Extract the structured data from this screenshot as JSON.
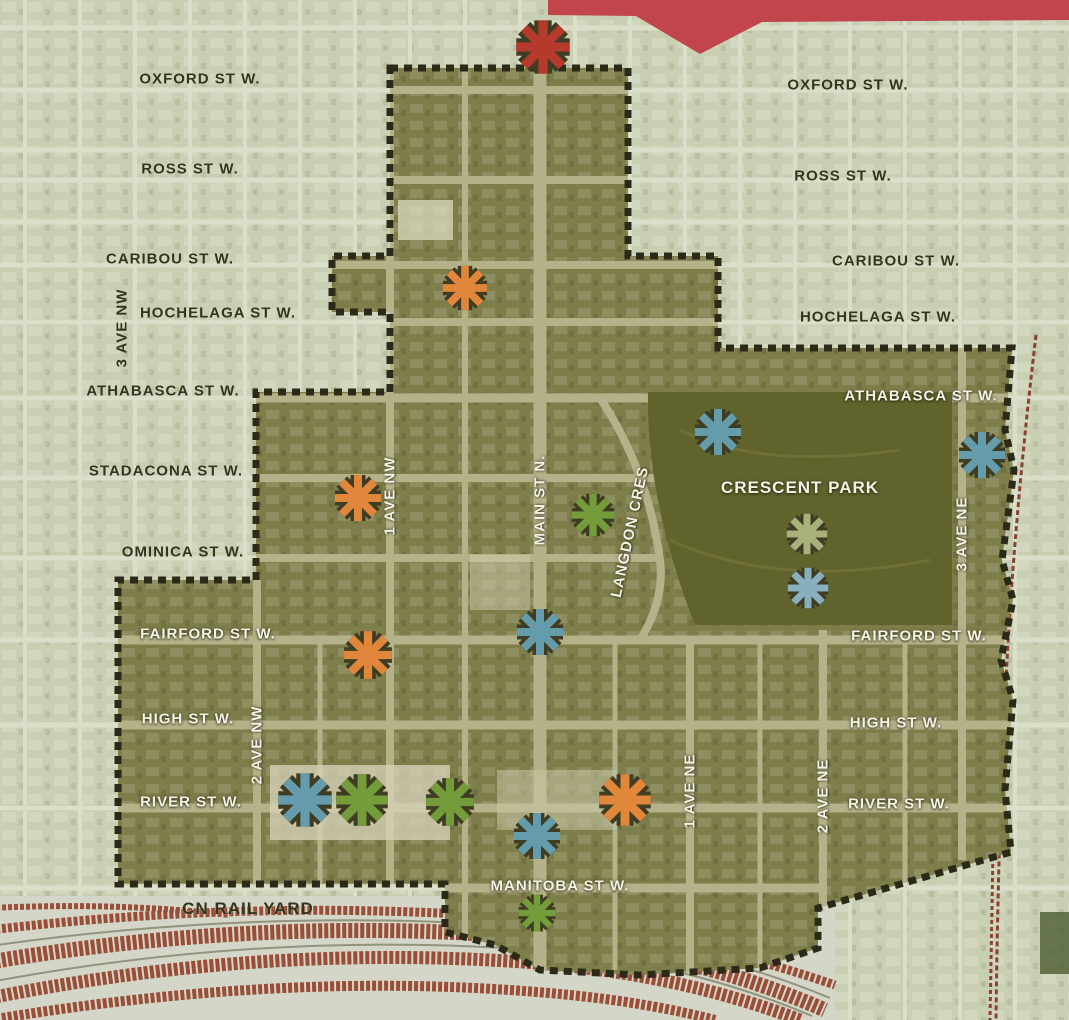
{
  "map": {
    "region": {
      "park_name": "CRESCENT PARK",
      "rail_yard_name": "CN RAIL YARD"
    },
    "palette": {
      "banner": "#c2444c",
      "outside_bg": "#c9cfb3",
      "inside_bg": "#7e7e4b",
      "park": "#61632d",
      "rail_band": "#9a4e39",
      "rail_line": "#8a4331",
      "boundary": "#2b2a19",
      "outline": "#3e3c22",
      "red": "#b53a2c",
      "orange": "#e1873c",
      "teal": "#649cab",
      "green": "#759c3b",
      "sage": "#a8b17b",
      "lightblue": "#87afbd"
    },
    "street_labels": [
      {
        "id": "oxford-st-w-left",
        "text": "OXFORD ST W.",
        "x": 200,
        "y": 79,
        "tone": "dark",
        "rot": 0
      },
      {
        "id": "oxford-st-w-right",
        "text": "OXFORD ST W.",
        "x": 848,
        "y": 85,
        "tone": "dark",
        "rot": 0
      },
      {
        "id": "ross-st-w-left",
        "text": "ROSS ST W.",
        "x": 190,
        "y": 169,
        "tone": "dark",
        "rot": 0
      },
      {
        "id": "ross-st-w-right",
        "text": "ROSS ST W.",
        "x": 843,
        "y": 176,
        "tone": "dark",
        "rot": 0
      },
      {
        "id": "caribou-st-w-left",
        "text": "CARIBOU ST W.",
        "x": 170,
        "y": 259,
        "tone": "dark",
        "rot": 0
      },
      {
        "id": "caribou-st-w-right",
        "text": "CARIBOU ST W.",
        "x": 896,
        "y": 261,
        "tone": "dark",
        "rot": 0
      },
      {
        "id": "hochelaga-st-w-left",
        "text": "HOCHELAGA ST W.",
        "x": 218,
        "y": 313,
        "tone": "dark",
        "rot": 0
      },
      {
        "id": "hochelaga-st-w-right",
        "text": "HOCHELAGA ST W.",
        "x": 878,
        "y": 317,
        "tone": "dark",
        "rot": 0
      },
      {
        "id": "athabasca-st-w-left",
        "text": "ATHABASCA ST W.",
        "x": 163,
        "y": 391,
        "tone": "dark",
        "rot": 0
      },
      {
        "id": "athabasca-st-w-right",
        "text": "ATHABASCA ST W.",
        "x": 921,
        "y": 396,
        "tone": "light",
        "rot": 0
      },
      {
        "id": "stadacona-st-w-left",
        "text": "STADACONA ST W.",
        "x": 166,
        "y": 471,
        "tone": "dark",
        "rot": 0
      },
      {
        "id": "ominica-st-w-left",
        "text": "OMINICA ST W.",
        "x": 183,
        "y": 552,
        "tone": "dark",
        "rot": 0
      },
      {
        "id": "fairford-st-w-left",
        "text": "FAIRFORD ST W.",
        "x": 208,
        "y": 634,
        "tone": "light",
        "rot": 0
      },
      {
        "id": "fairford-st-w-right",
        "text": "FAIRFORD ST W.",
        "x": 919,
        "y": 636,
        "tone": "light",
        "rot": 0
      },
      {
        "id": "high-st-w-left",
        "text": "HIGH ST W.",
        "x": 188,
        "y": 719,
        "tone": "light",
        "rot": 0
      },
      {
        "id": "high-st-w-right",
        "text": "HIGH ST W.",
        "x": 896,
        "y": 723,
        "tone": "light",
        "rot": 0
      },
      {
        "id": "river-st-w-left",
        "text": "RIVER ST W.",
        "x": 191,
        "y": 802,
        "tone": "light",
        "rot": 0
      },
      {
        "id": "river-st-w-right",
        "text": "RIVER ST W.",
        "x": 899,
        "y": 804,
        "tone": "light",
        "rot": 0
      },
      {
        "id": "manitoba-st-w",
        "text": "MANITOBA ST W.",
        "x": 560,
        "y": 886,
        "tone": "light",
        "rot": 0
      },
      {
        "id": "cn-rail-yard",
        "text": "CN RAIL YARD",
        "x": 248,
        "y": 909,
        "tone": "dark",
        "rot": 0,
        "size": 17
      },
      {
        "id": "crescent-park",
        "text": "CRESCENT PARK",
        "x": 800,
        "y": 488,
        "tone": "light",
        "rot": 0,
        "size": 17
      },
      {
        "id": "3-ave-nw",
        "text": "3 AVE NW",
        "x": 122,
        "y": 328,
        "tone": "dark",
        "rot": -90
      },
      {
        "id": "1-ave-nw",
        "text": "1 AVE NW",
        "x": 390,
        "y": 496,
        "tone": "light",
        "rot": -90
      },
      {
        "id": "2-ave-nw",
        "text": "2 AVE NW",
        "x": 257,
        "y": 745,
        "tone": "light",
        "rot": -90
      },
      {
        "id": "main-st-n",
        "text": "MAIN ST N.",
        "x": 540,
        "y": 500,
        "tone": "light",
        "rot": -90
      },
      {
        "id": "langdon-cres",
        "text": "LANGDON CRES",
        "x": 630,
        "y": 532,
        "tone": "light",
        "rot": -78
      },
      {
        "id": "1-ave-ne",
        "text": "1 AVE NE",
        "x": 690,
        "y": 791,
        "tone": "light",
        "rot": -90
      },
      {
        "id": "2-ave-ne",
        "text": "2 AVE NE",
        "x": 823,
        "y": 796,
        "tone": "light",
        "rot": -90
      },
      {
        "id": "3-ave-ne",
        "text": "3 AVE NE",
        "x": 962,
        "y": 534,
        "tone": "light",
        "rot": -90
      }
    ],
    "markers": [
      {
        "x": 543,
        "y": 47,
        "color": "red",
        "size": 58
      },
      {
        "x": 465,
        "y": 288,
        "color": "orange",
        "size": 48
      },
      {
        "x": 358,
        "y": 498,
        "color": "orange",
        "size": 50
      },
      {
        "x": 368,
        "y": 655,
        "color": "orange",
        "size": 52
      },
      {
        "x": 625,
        "y": 800,
        "color": "orange",
        "size": 56
      },
      {
        "x": 718,
        "y": 432,
        "color": "teal",
        "size": 50
      },
      {
        "x": 982,
        "y": 455,
        "color": "teal",
        "size": 50
      },
      {
        "x": 593,
        "y": 515,
        "color": "green",
        "size": 46
      },
      {
        "x": 807,
        "y": 534,
        "color": "sage",
        "size": 44
      },
      {
        "x": 808,
        "y": 588,
        "color": "lightblue",
        "size": 44
      },
      {
        "x": 540,
        "y": 632,
        "color": "teal",
        "size": 50
      },
      {
        "x": 305,
        "y": 800,
        "color": "teal",
        "size": 58
      },
      {
        "x": 362,
        "y": 800,
        "color": "green",
        "size": 56
      },
      {
        "x": 450,
        "y": 802,
        "color": "green",
        "size": 52
      },
      {
        "x": 537,
        "y": 836,
        "color": "teal",
        "size": 50
      },
      {
        "x": 537,
        "y": 913,
        "color": "green",
        "size": 40
      }
    ]
  }
}
